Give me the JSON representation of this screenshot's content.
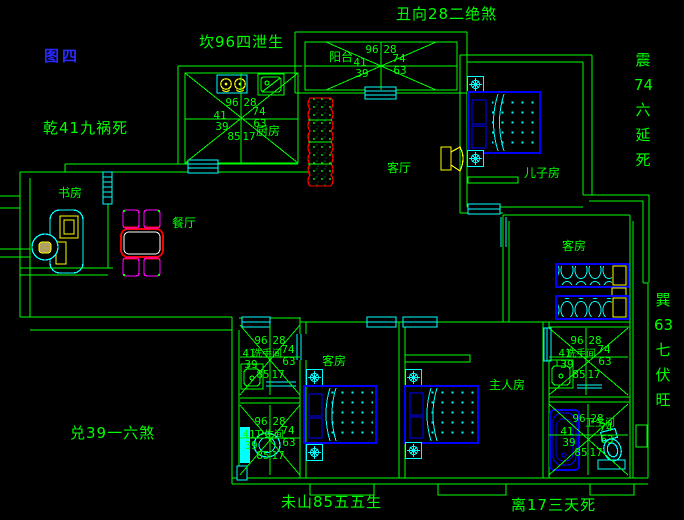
{
  "figure_label": "图四",
  "annotations": {
    "top": "丑向28二绝煞",
    "top_left": "坎96四泄生",
    "left": "乾41九祸死",
    "bottom_left": "兑39一六煞",
    "bottom_center": "未山85五五生",
    "bottom_right": "离17三天死",
    "right_top": [
      "震",
      "74",
      "六",
      "延",
      "死"
    ],
    "right_bottom": [
      "巽",
      "63",
      "七",
      "伏",
      "旺"
    ]
  },
  "rooms": {
    "kitchen": "厨房",
    "balcony": "阳台",
    "living": "客厅",
    "son_room": "儿子房",
    "guest_right": "客房",
    "dining": "餐厅",
    "study": "书房",
    "guest_bottom": "客房",
    "master": "主人房",
    "washroom_left": "洗手间",
    "toilet_left": "卫生间",
    "washroom_right": "洗手间",
    "toilet_right": "卫生间"
  },
  "compass_numbers": {
    "tl": "96",
    "tr": "28",
    "l": "41",
    "r": "74",
    "bl": "39",
    "br": "63",
    "b1": "85",
    "b2": "17"
  },
  "colors": {
    "wall": "#00ff00",
    "window_door": "#00ffff",
    "bed": "#0000ff",
    "appliance": "#ffff00",
    "table_planter": "#ff0000",
    "chair": "#ff00ff",
    "figure_label": "#2a2aff",
    "annotation_text": "#00ff00"
  }
}
